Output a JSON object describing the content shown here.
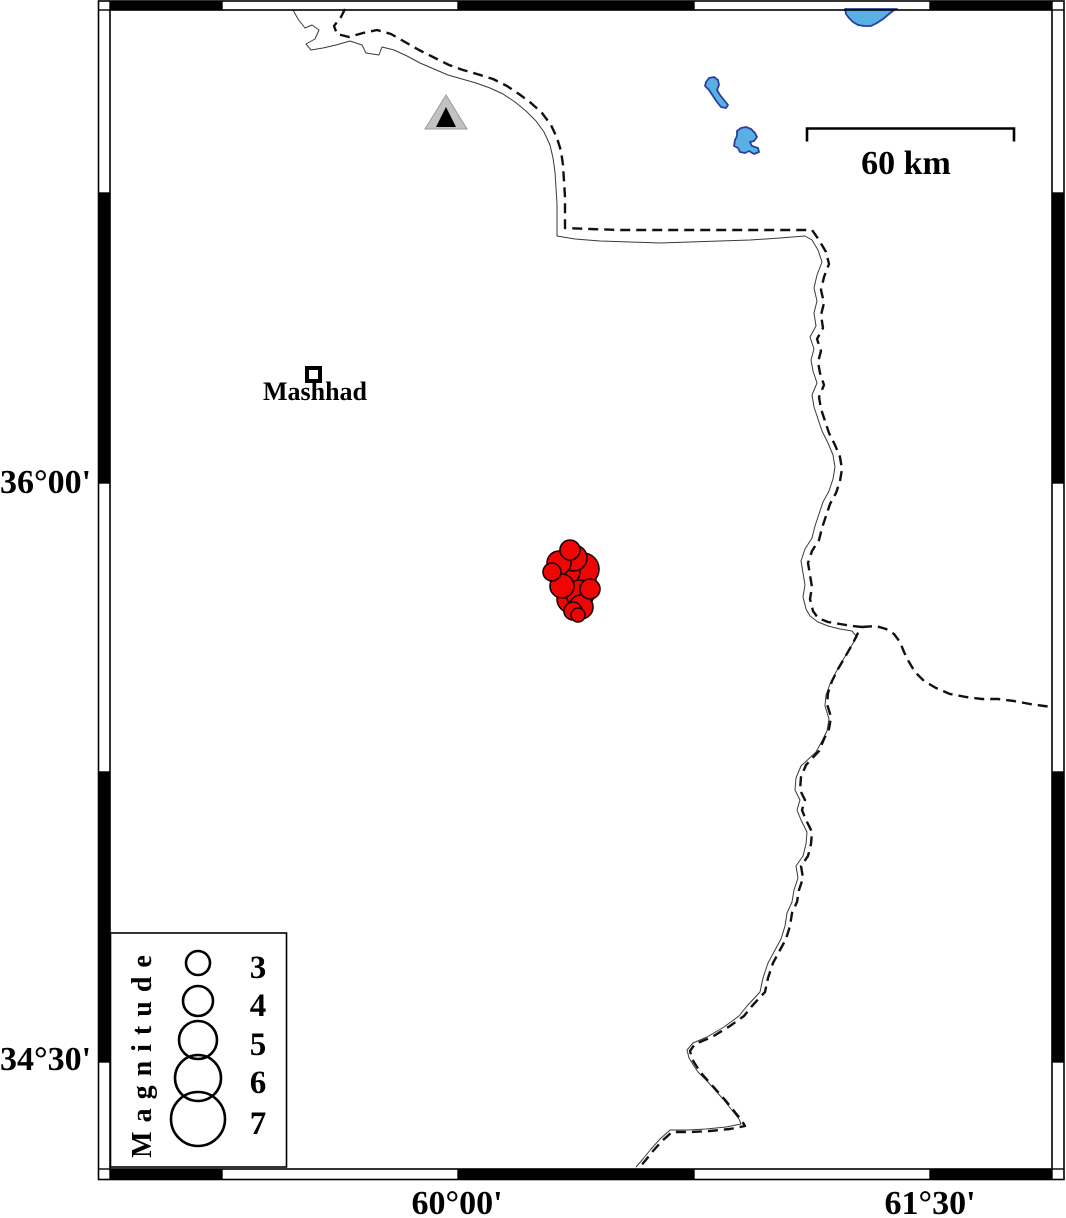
{
  "axis": {
    "lat": [
      {
        "text": "36°00'",
        "y": 483
      },
      {
        "text": "34°30'",
        "y": 1060
      }
    ],
    "lon": [
      {
        "text": "60°00'",
        "x": 457
      },
      {
        "text": "61°30'",
        "x": 930
      }
    ]
  },
  "scale_bar": {
    "label": "60 km",
    "distance_km": 60
  },
  "city": {
    "name": "Mashhad"
  },
  "legend": {
    "title": "Magnitude",
    "items": [
      {
        "label": "3"
      },
      {
        "label": "4"
      },
      {
        "label": "5"
      },
      {
        "label": "6"
      },
      {
        "label": "7"
      }
    ]
  },
  "colors": {
    "earthquake_fill": "#f00505",
    "earthquake_stroke": "#1a0000",
    "lake_fill": "#58b0e3",
    "lake_stroke": "#2a3f9f",
    "station_fill": "#c2c2c2",
    "station_inner": "#000000",
    "frame_black": "#000000",
    "border_color": "#111111"
  },
  "geometry": {
    "frame": {
      "outer": [
        98.5,
        1,
        1064,
        1179.5
      ],
      "inner": [
        110,
        10,
        1052,
        1169
      ],
      "h_transitions": [
        222,
        458,
        694,
        930
      ],
      "v_transitions": [
        193,
        483,
        772,
        1062
      ],
      "top_black": [
        [
          110,
          222
        ],
        [
          458,
          694
        ],
        [
          930,
          1052
        ]
      ],
      "bottom_black": [
        [
          110,
          222
        ],
        [
          458,
          694
        ],
        [
          930,
          1052
        ]
      ],
      "left_black": [
        [
          193,
          483
        ],
        [
          772,
          1062
        ]
      ],
      "right_black": [
        [
          193,
          483
        ],
        [
          772,
          1062
        ]
      ]
    },
    "scale_bar": {
      "x1": 807,
      "x2": 1014,
      "y": 128.5,
      "tick": 13
    },
    "city_marker": {
      "x": 307,
      "y": 368,
      "size": 13
    },
    "station": {
      "outer": [
        [
          446,
          95
        ],
        [
          425,
          129
        ],
        [
          467,
          129
        ]
      ],
      "inner": [
        [
          446,
          107
        ],
        [
          436,
          127
        ],
        [
          456,
          127
        ]
      ]
    },
    "lakes": [
      [
        [
          845,
          9
        ],
        [
          846,
          14
        ],
        [
          849,
          18
        ],
        [
          853,
          22
        ],
        [
          858,
          25
        ],
        [
          864,
          26
        ],
        [
          871,
          26
        ],
        [
          877,
          23
        ],
        [
          883,
          19
        ],
        [
          889,
          14
        ],
        [
          894,
          10
        ],
        [
          897,
          9
        ]
      ],
      [
        [
          706,
          82
        ],
        [
          709,
          78
        ],
        [
          714,
          77
        ],
        [
          718,
          80
        ],
        [
          719,
          85
        ],
        [
          717,
          90
        ],
        [
          720,
          95
        ],
        [
          724,
          100
        ],
        [
          728,
          105
        ],
        [
          726,
          108
        ],
        [
          721,
          107
        ],
        [
          717,
          102
        ],
        [
          713,
          96
        ],
        [
          709,
          90
        ],
        [
          705,
          86
        ]
      ],
      [
        [
          737,
          131
        ],
        [
          741,
          128
        ],
        [
          746,
          127
        ],
        [
          751,
          129
        ],
        [
          755,
          133
        ],
        [
          757,
          137
        ],
        [
          754,
          141
        ],
        [
          750,
          142
        ],
        [
          752,
          146
        ],
        [
          758,
          148
        ],
        [
          759,
          152
        ],
        [
          754,
          154
        ],
        [
          749,
          151
        ],
        [
          745,
          153
        ],
        [
          740,
          152
        ],
        [
          738,
          148
        ],
        [
          734,
          146
        ],
        [
          735,
          140
        ],
        [
          737,
          136
        ]
      ]
    ],
    "border_dashed": [
      [
        345,
        9
      ],
      [
        341,
        17
      ],
      [
        334,
        26
      ],
      [
        337,
        34
      ],
      [
        349,
        37
      ],
      [
        363,
        33
      ],
      [
        377,
        30
      ],
      [
        391,
        34
      ],
      [
        405,
        42
      ],
      [
        419,
        50
      ],
      [
        433,
        57
      ],
      [
        449,
        65
      ],
      [
        463,
        70
      ],
      [
        477,
        74
      ],
      [
        493,
        79
      ],
      [
        507,
        86
      ],
      [
        519,
        94
      ],
      [
        531,
        103
      ],
      [
        542,
        113
      ],
      [
        551,
        125
      ],
      [
        557,
        138
      ],
      [
        561,
        151
      ],
      [
        563,
        165
      ],
      [
        564,
        181
      ],
      [
        565,
        197
      ],
      [
        565,
        213
      ],
      [
        565,
        228
      ],
      [
        590,
        229
      ],
      [
        620,
        230
      ],
      [
        655,
        230
      ],
      [
        690,
        230
      ],
      [
        725,
        230
      ],
      [
        760,
        230
      ],
      [
        790,
        230
      ],
      [
        812,
        230
      ],
      [
        819,
        240
      ],
      [
        826,
        252
      ],
      [
        829,
        264
      ],
      [
        824,
        277
      ],
      [
        821,
        290
      ],
      [
        824,
        303
      ],
      [
        821,
        315
      ],
      [
        823,
        328
      ],
      [
        817,
        339
      ],
      [
        821,
        351
      ],
      [
        818,
        362
      ],
      [
        820,
        373
      ],
      [
        824,
        385
      ],
      [
        819,
        397
      ],
      [
        821,
        409
      ],
      [
        825,
        421
      ],
      [
        829,
        433
      ],
      [
        835,
        445
      ],
      [
        840,
        457
      ],
      [
        842,
        469
      ],
      [
        840,
        481
      ],
      [
        836,
        493
      ],
      [
        830,
        504
      ],
      [
        826,
        516
      ],
      [
        822,
        528
      ],
      [
        819,
        540
      ],
      [
        812,
        551
      ],
      [
        808,
        563
      ],
      [
        810,
        575
      ],
      [
        812,
        587
      ],
      [
        810,
        599
      ],
      [
        813,
        611
      ],
      [
        818,
        618
      ],
      [
        828,
        622
      ],
      [
        840,
        624
      ],
      [
        852,
        626
      ],
      [
        862,
        627
      ],
      [
        858,
        633
      ],
      [
        852,
        645
      ],
      [
        845,
        657
      ],
      [
        838,
        669
      ],
      [
        832,
        681
      ],
      [
        828,
        693
      ],
      [
        827,
        704
      ],
      [
        831,
        717
      ],
      [
        829,
        729
      ],
      [
        824,
        739
      ],
      [
        819,
        751
      ],
      [
        806,
        765
      ],
      [
        801,
        777
      ],
      [
        800,
        790
      ],
      [
        805,
        800
      ],
      [
        802,
        810
      ],
      [
        806,
        820
      ],
      [
        812,
        832
      ],
      [
        811,
        844
      ],
      [
        808,
        856
      ],
      [
        801,
        866
      ],
      [
        803,
        878
      ],
      [
        799,
        890
      ],
      [
        797,
        902
      ],
      [
        792,
        913
      ],
      [
        790,
        926
      ],
      [
        786,
        939
      ],
      [
        780,
        950
      ],
      [
        773,
        963
      ],
      [
        768,
        978
      ],
      [
        765,
        992
      ],
      [
        752,
        1006
      ],
      [
        744,
        1016
      ],
      [
        730,
        1026
      ],
      [
        712,
        1037
      ],
      [
        695,
        1044
      ],
      [
        690,
        1051
      ],
      [
        692,
        1059
      ],
      [
        697,
        1067
      ],
      [
        701,
        1073
      ],
      [
        710,
        1083
      ],
      [
        718,
        1092
      ],
      [
        726,
        1101
      ],
      [
        734,
        1111
      ],
      [
        742,
        1121
      ],
      [
        745,
        1126
      ],
      [
        730,
        1129
      ],
      [
        710,
        1131
      ],
      [
        690,
        1132
      ],
      [
        672,
        1132
      ],
      [
        662,
        1141
      ],
      [
        653,
        1151
      ],
      [
        645,
        1161
      ],
      [
        638,
        1169
      ]
    ],
    "border_branch": [
      [
        862,
        627
      ],
      [
        876,
        626
      ],
      [
        886,
        629
      ],
      [
        894,
        634
      ],
      [
        900,
        642
      ],
      [
        904,
        652
      ],
      [
        909,
        662
      ],
      [
        915,
        672
      ],
      [
        924,
        681
      ],
      [
        936,
        688
      ],
      [
        950,
        694
      ],
      [
        966,
        697
      ],
      [
        982,
        699
      ],
      [
        998,
        699
      ],
      [
        1014,
        701
      ],
      [
        1030,
        704
      ],
      [
        1044,
        706
      ],
      [
        1052,
        707
      ]
    ],
    "border_thin": [
      [
        293,
        10
      ],
      [
        298,
        19
      ],
      [
        305,
        28
      ],
      [
        312,
        25
      ],
      [
        319,
        30
      ],
      [
        315,
        39
      ],
      [
        306,
        44
      ],
      [
        311,
        50
      ],
      [
        323,
        48
      ],
      [
        336,
        45
      ],
      [
        350,
        41
      ],
      [
        362,
        45
      ],
      [
        366,
        53
      ],
      [
        379,
        55
      ],
      [
        382,
        47
      ],
      [
        394,
        50
      ],
      [
        407,
        56
      ],
      [
        420,
        63
      ],
      [
        434,
        69
      ],
      [
        448,
        75
      ],
      [
        462,
        79
      ],
      [
        476,
        83
      ],
      [
        490,
        88
      ],
      [
        503,
        94
      ],
      [
        515,
        102
      ],
      [
        526,
        111
      ],
      [
        536,
        121
      ],
      [
        544,
        132
      ],
      [
        550,
        145
      ],
      [
        553,
        158
      ],
      [
        555,
        172
      ],
      [
        556,
        188
      ],
      [
        557,
        204
      ],
      [
        557,
        220
      ],
      [
        557,
        236
      ],
      [
        575,
        239
      ],
      [
        600,
        241
      ],
      [
        630,
        242
      ],
      [
        660,
        243
      ],
      [
        690,
        242
      ],
      [
        720,
        241
      ],
      [
        750,
        240
      ],
      [
        780,
        238
      ],
      [
        805,
        236
      ],
      [
        812,
        240
      ],
      [
        818,
        250
      ],
      [
        822,
        262
      ],
      [
        817,
        275
      ],
      [
        814,
        288
      ],
      [
        817,
        301
      ],
      [
        814,
        313
      ],
      [
        816,
        326
      ],
      [
        810,
        337
      ],
      [
        814,
        349
      ],
      [
        811,
        360
      ],
      [
        813,
        371
      ],
      [
        817,
        383
      ],
      [
        812,
        395
      ],
      [
        814,
        407
      ],
      [
        818,
        419
      ],
      [
        822,
        431
      ],
      [
        828,
        443
      ],
      [
        833,
        455
      ],
      [
        835,
        467
      ],
      [
        833,
        479
      ],
      [
        829,
        491
      ],
      [
        823,
        502
      ],
      [
        819,
        514
      ],
      [
        815,
        526
      ],
      [
        812,
        538
      ],
      [
        805,
        549
      ],
      [
        801,
        561
      ],
      [
        803,
        573
      ],
      [
        805,
        585
      ],
      [
        803,
        597
      ],
      [
        806,
        609
      ],
      [
        810,
        616
      ],
      [
        818,
        622
      ],
      [
        828,
        626
      ],
      [
        840,
        629
      ],
      [
        852,
        631
      ],
      [
        857,
        637
      ],
      [
        850,
        648
      ],
      [
        843,
        660
      ],
      [
        836,
        672
      ],
      [
        830,
        684
      ],
      [
        826,
        695
      ],
      [
        825,
        706
      ],
      [
        829,
        719
      ],
      [
        827,
        731
      ],
      [
        822,
        741
      ],
      [
        816,
        752
      ],
      [
        801,
        766
      ],
      [
        796,
        778
      ],
      [
        795,
        790
      ],
      [
        800,
        800
      ],
      [
        797,
        810
      ],
      [
        801,
        820
      ],
      [
        807,
        832
      ],
      [
        806,
        844
      ],
      [
        803,
        856
      ],
      [
        796,
        866
      ],
      [
        798,
        878
      ],
      [
        794,
        890
      ],
      [
        792,
        902
      ],
      [
        787,
        913
      ],
      [
        785,
        926
      ],
      [
        781,
        939
      ],
      [
        775,
        950
      ],
      [
        768,
        963
      ],
      [
        763,
        978
      ],
      [
        760,
        992
      ],
      [
        747,
        1006
      ],
      [
        739,
        1016
      ],
      [
        724,
        1027
      ],
      [
        707,
        1037
      ],
      [
        693,
        1043
      ],
      [
        687,
        1050
      ],
      [
        689,
        1058
      ],
      [
        694,
        1066
      ],
      [
        698,
        1072
      ],
      [
        707,
        1081
      ],
      [
        715,
        1090
      ],
      [
        723,
        1099
      ],
      [
        731,
        1109
      ],
      [
        739,
        1119
      ],
      [
        741,
        1124
      ],
      [
        726,
        1127
      ],
      [
        706,
        1129
      ],
      [
        688,
        1130
      ],
      [
        670,
        1130
      ],
      [
        660,
        1139
      ],
      [
        651,
        1149
      ],
      [
        643,
        1159
      ],
      [
        636,
        1167
      ]
    ],
    "earthquakes": [
      [
        575,
        581,
        21
      ],
      [
        583,
        569,
        16
      ],
      [
        565,
        571,
        15
      ],
      [
        571,
        599,
        14
      ],
      [
        580,
        594,
        14
      ],
      [
        574,
        558,
        13
      ],
      [
        559,
        563,
        12
      ],
      [
        562,
        586,
        12
      ],
      [
        581,
        607,
        12
      ],
      [
        570,
        550,
        10
      ],
      [
        590,
        589,
        10
      ],
      [
        552,
        572,
        9
      ],
      [
        573,
        611,
        9
      ],
      [
        578,
        615,
        7
      ]
    ],
    "legend_box": [
      110.5,
      933,
      176,
      234
    ],
    "legend_circles": {
      "cx": 198,
      "items": [
        [
          963,
          12
        ],
        [
          1001,
          15
        ],
        [
          1040,
          19
        ],
        [
          1078,
          23
        ],
        [
          1119,
          27
        ]
      ]
    }
  }
}
